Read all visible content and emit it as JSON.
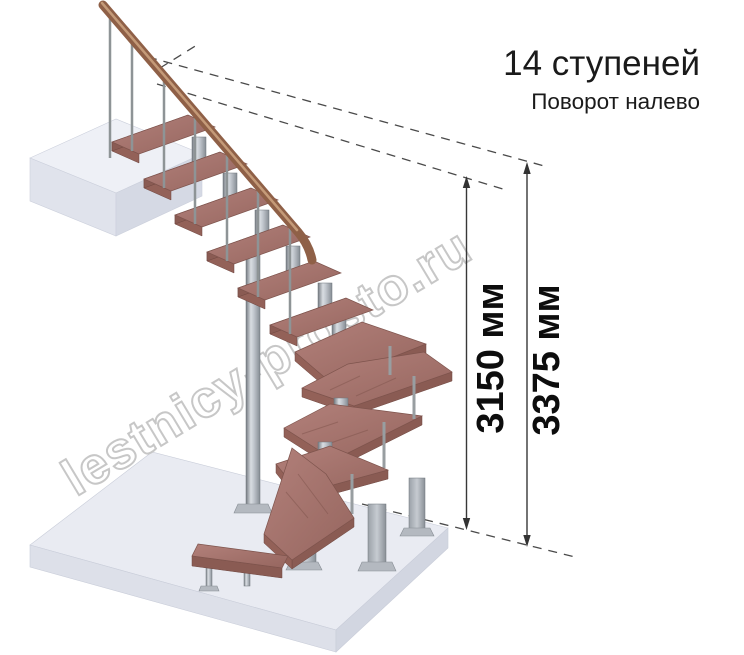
{
  "header": {
    "title": "14 ступеней",
    "subtitle": "Поворот налево"
  },
  "dimensions": {
    "d3150": "3150 мм",
    "d3375": "3375 мм"
  },
  "watermark": {
    "text": "lestnicy-prosto.ru"
  },
  "palette": {
    "wood_top": "#a5736c",
    "wood_front": "#8a5b53",
    "metal": "#9aa1a8",
    "floor_top": "#e9ebf2",
    "platform_top": "#eef0f6",
    "dimension_line": "#383838",
    "text": "#1a1a1a",
    "watermark_stroke": "#c5c5c5"
  }
}
